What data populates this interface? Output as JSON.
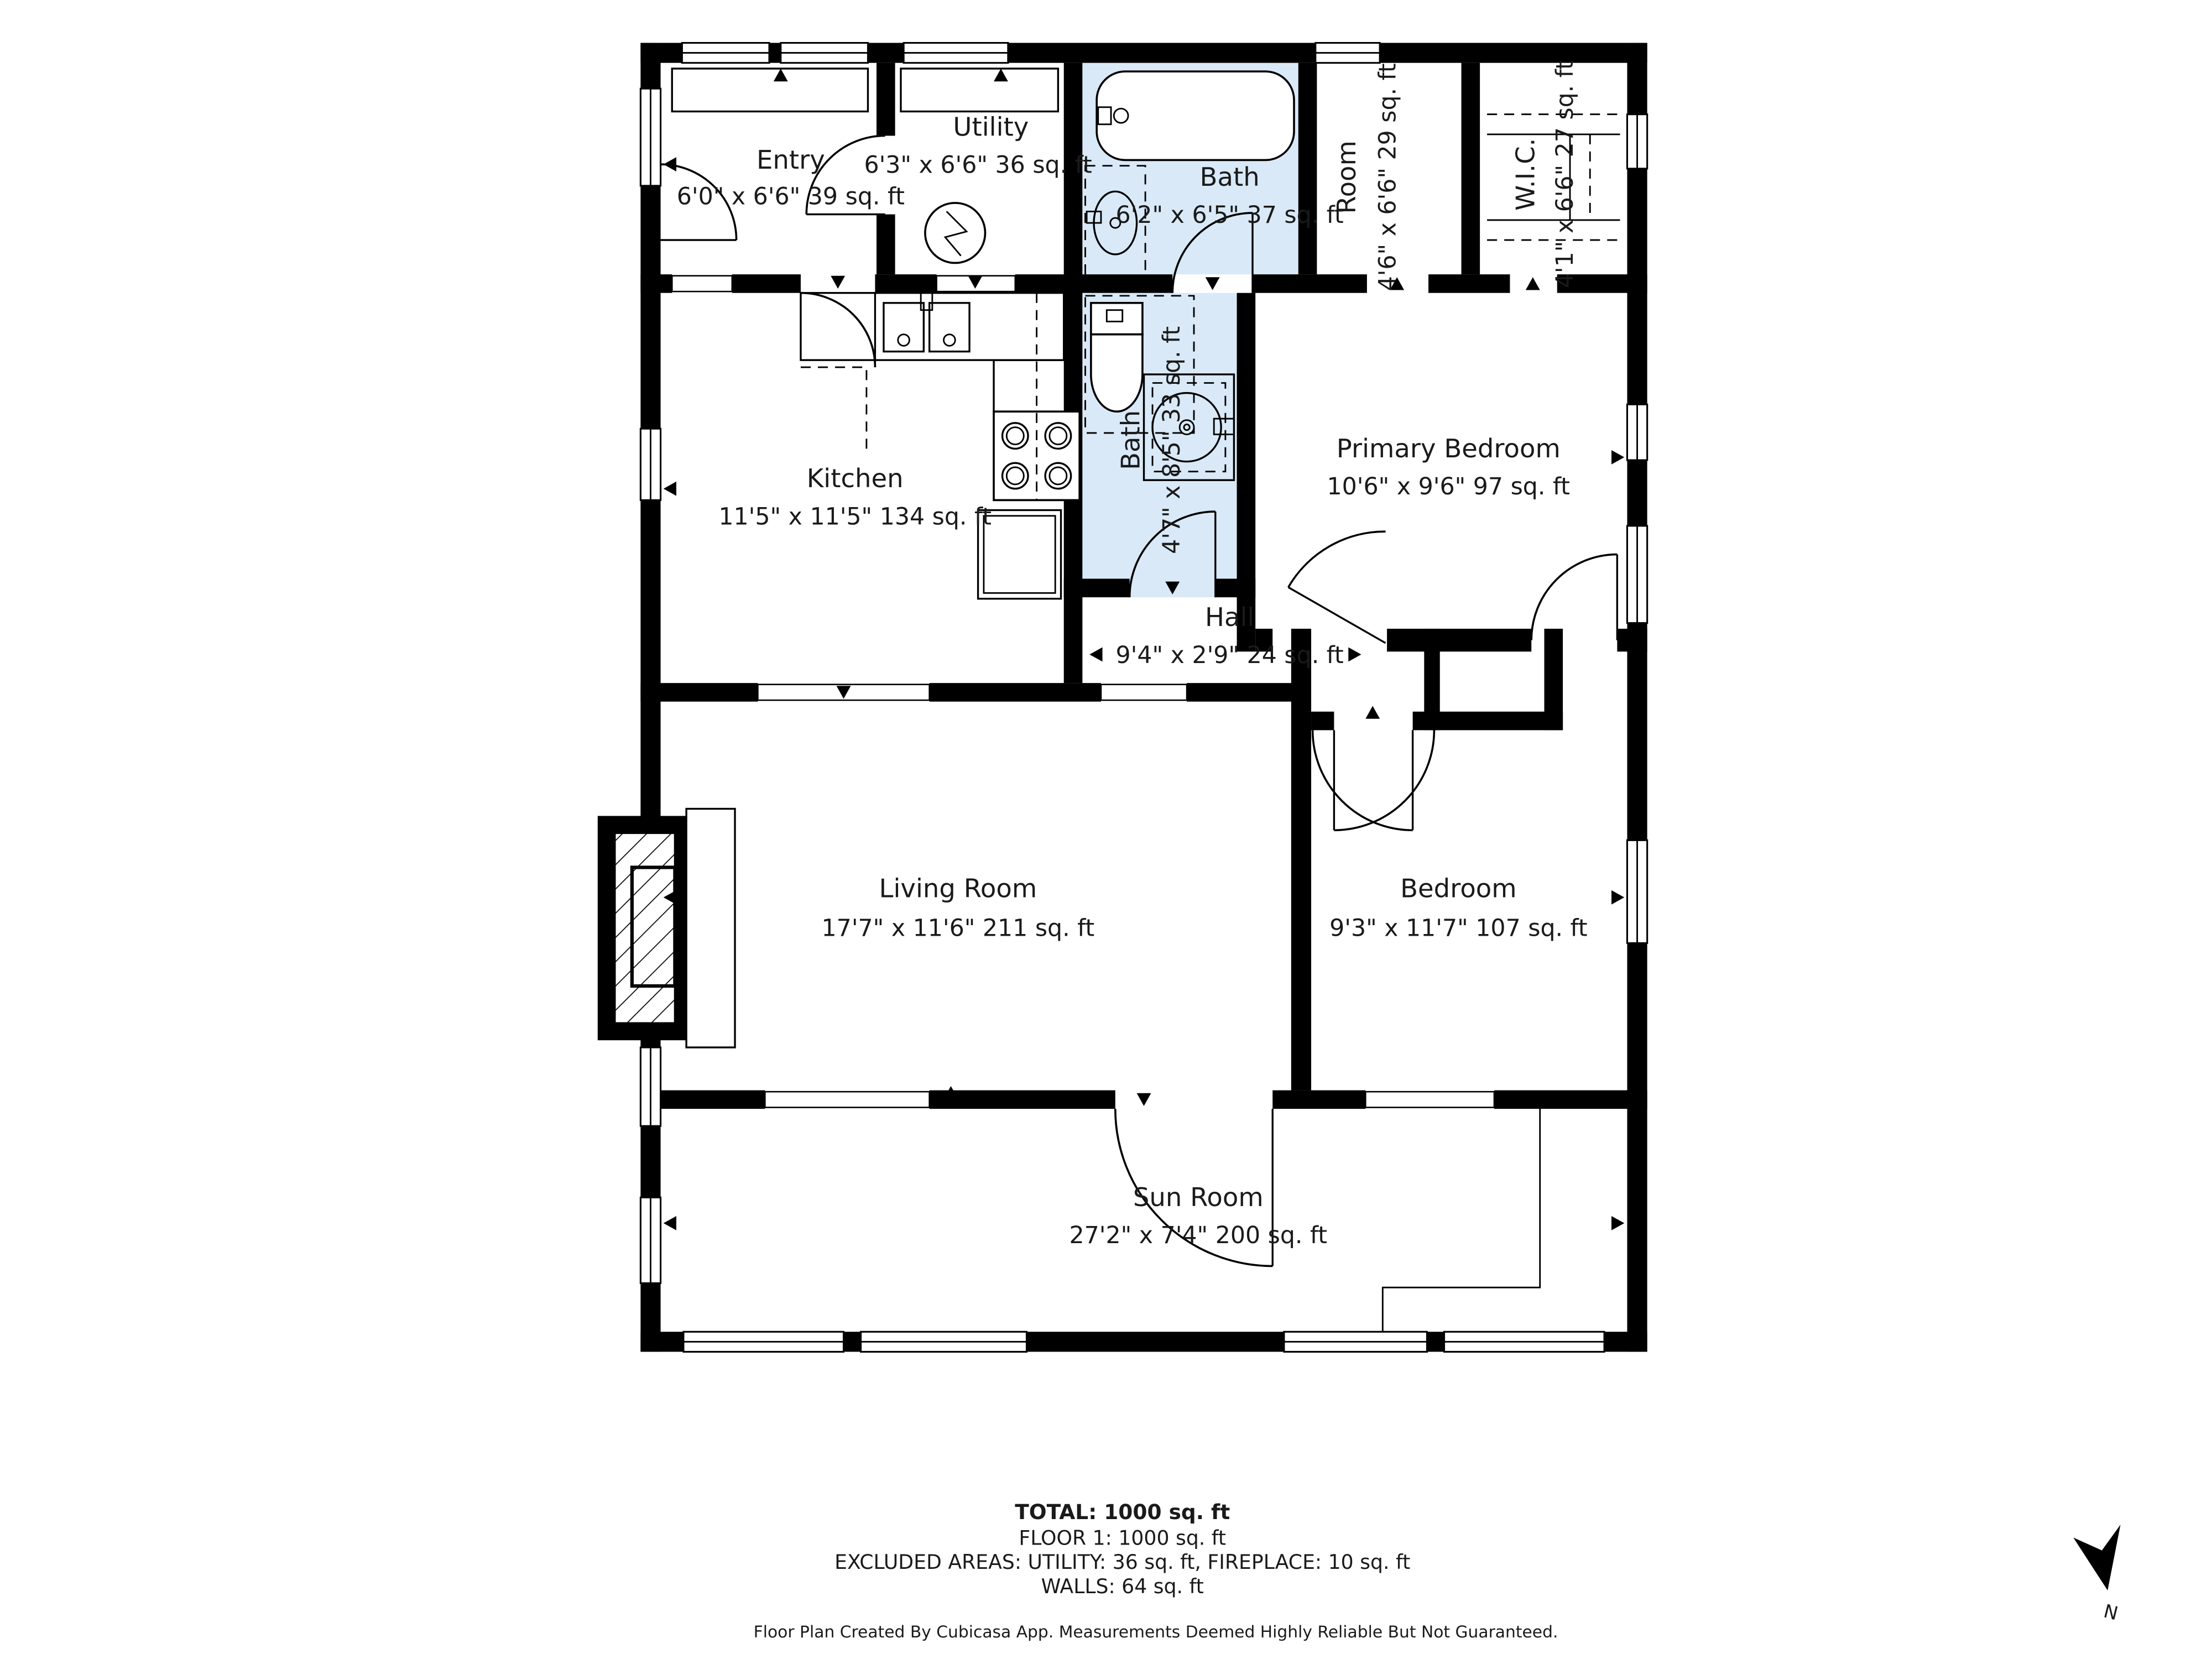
{
  "title": "Floor plan - Floor 1",
  "rooms": {
    "entry": {
      "name": "Entry",
      "dims": "6'0\" x 6'6\" 39 sq. ft"
    },
    "utility": {
      "name": "Utility",
      "dims": "6'3\" x 6'6\" 36 sq. ft"
    },
    "bath_top": {
      "name": "Bath",
      "dims": "6'2\" x 6'5\" 37 sq. ft"
    },
    "room": {
      "name": "Room",
      "dims": "4'6\" x 6'6\" 29 sq. ft"
    },
    "wic": {
      "name": "W.I.C.",
      "dims": "4'1\" x 6'6\" 27 sq. ft"
    },
    "kitchen": {
      "name": "Kitchen",
      "dims": "11'5\" x 11'5\" 134 sq. ft"
    },
    "bath_mid": {
      "name": "Bath",
      "dims": "4'7\" x 8'5\" 33 sq. ft"
    },
    "primary": {
      "name": "Primary Bedroom",
      "dims": "10'6\" x 9'6\" 97 sq. ft"
    },
    "hall": {
      "name": "Hall",
      "dims": "9'4\" x 2'9\" 24 sq. ft"
    },
    "living": {
      "name": "Living Room",
      "dims": "17'7\" x 11'6\" 211 sq. ft"
    },
    "bedroom": {
      "name": "Bedroom",
      "dims": "9'3\" x 11'7\" 107 sq. ft"
    },
    "sunroom": {
      "name": "Sun Room",
      "dims": "27'2\" x 7'4\" 200 sq. ft"
    }
  },
  "footer": {
    "total": "TOTAL: 1000 sq. ft",
    "floor": "FLOOR 1: 1000 sq. ft",
    "excluded": "EXCLUDED AREAS: UTILITY: 36 sq. ft, FIREPLACE: 10 sq. ft",
    "walls": "WALLS: 64 sq. ft",
    "disclaimer": "Floor Plan Created By Cubicasa App. Measurements Deemed Highly Reliable But Not Guaranteed."
  },
  "compass": {
    "label": "N"
  },
  "colors": {
    "wall": "#000000",
    "bath_fill": "#d9e9f7",
    "background": "#ffffff"
  }
}
